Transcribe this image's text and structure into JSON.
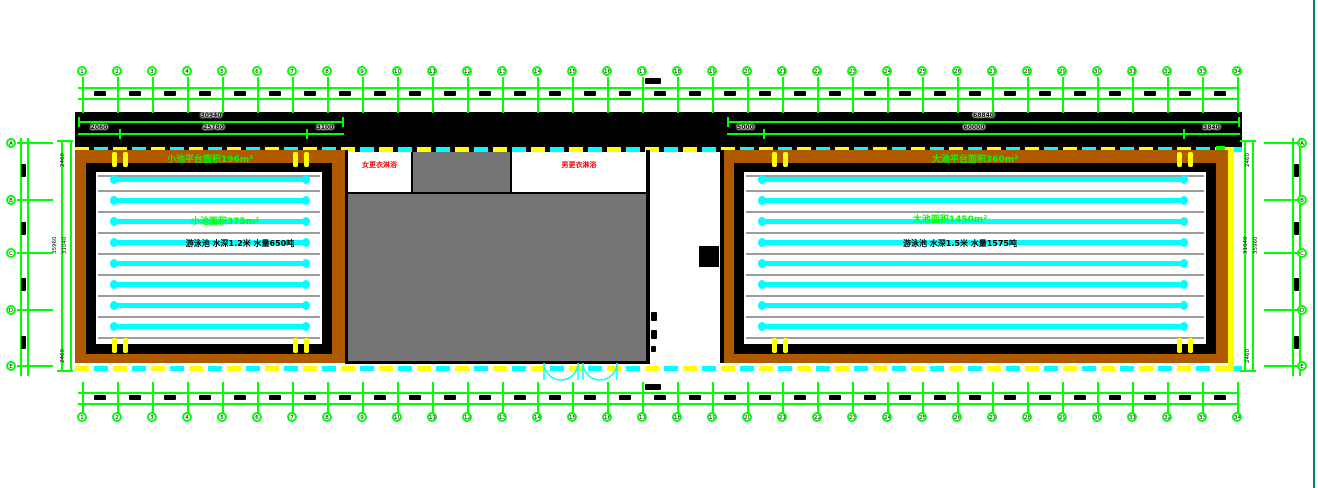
{
  "colors": {
    "grid_green": "#00ff00",
    "lane_cyan": "#00ffff",
    "boundary_yellow": "#ffff00",
    "room_label_red": "#ff0000",
    "deck_brown": "#b05a00",
    "building_gray": "#757575",
    "rope_gray": "#9c9c9c",
    "edge_teal": "#007f7f"
  },
  "grid": {
    "top_axis_labels": [
      "1",
      "2",
      "3",
      "4",
      "5",
      "6",
      "7",
      "8",
      "9",
      "10",
      "11",
      "12",
      "13",
      "14",
      "15",
      "16",
      "17",
      "18",
      "19",
      "20",
      "21",
      "22",
      "23",
      "24",
      "25",
      "26",
      "27",
      "28",
      "29",
      "30",
      "31",
      "32",
      "33",
      "34"
    ],
    "bottom_axis_labels": [
      "1",
      "2",
      "3",
      "4",
      "5",
      "6",
      "7",
      "8",
      "9",
      "10",
      "11",
      "12",
      "13",
      "14",
      "15",
      "16",
      "17",
      "18",
      "19",
      "20",
      "21",
      "22",
      "23",
      "24",
      "25",
      "26",
      "27",
      "28",
      "29",
      "30",
      "31",
      "32",
      "33",
      "34"
    ],
    "left_axis_labels": [
      "A",
      "B",
      "C",
      "D",
      "E"
    ],
    "right_axis_labels": [
      "A",
      "B",
      "C",
      "D",
      "E"
    ]
  },
  "dimensions": {
    "left_top": {
      "total": "30940",
      "segments": [
        "2060",
        "25780",
        "3100"
      ]
    },
    "right_top": {
      "total": "68840",
      "segments": [
        "5000",
        "60000",
        "3840"
      ]
    },
    "left_side": {
      "top": "2460",
      "inner": "31040",
      "outer": "35960",
      "bottom": "2460"
    },
    "right_side": {
      "top": "2460",
      "inner": "31040",
      "outer": "35960",
      "bottom": "2460"
    }
  },
  "pools": {
    "left": {
      "platform_label": "小池平台面积196m²",
      "area_label": "小池面积375m²",
      "spec_label": "游泳池 水深1.2米 水量650吨",
      "lane_count": 8
    },
    "right": {
      "platform_label": "大池平台面积360m²",
      "area_label": "大池面积1450m²",
      "spec_label": "游泳池 水深1.5米 水量1575吨",
      "lane_count": 8
    }
  },
  "building": {
    "left_room_label": "女更衣淋浴",
    "right_room_label": "男更衣淋浴"
  }
}
